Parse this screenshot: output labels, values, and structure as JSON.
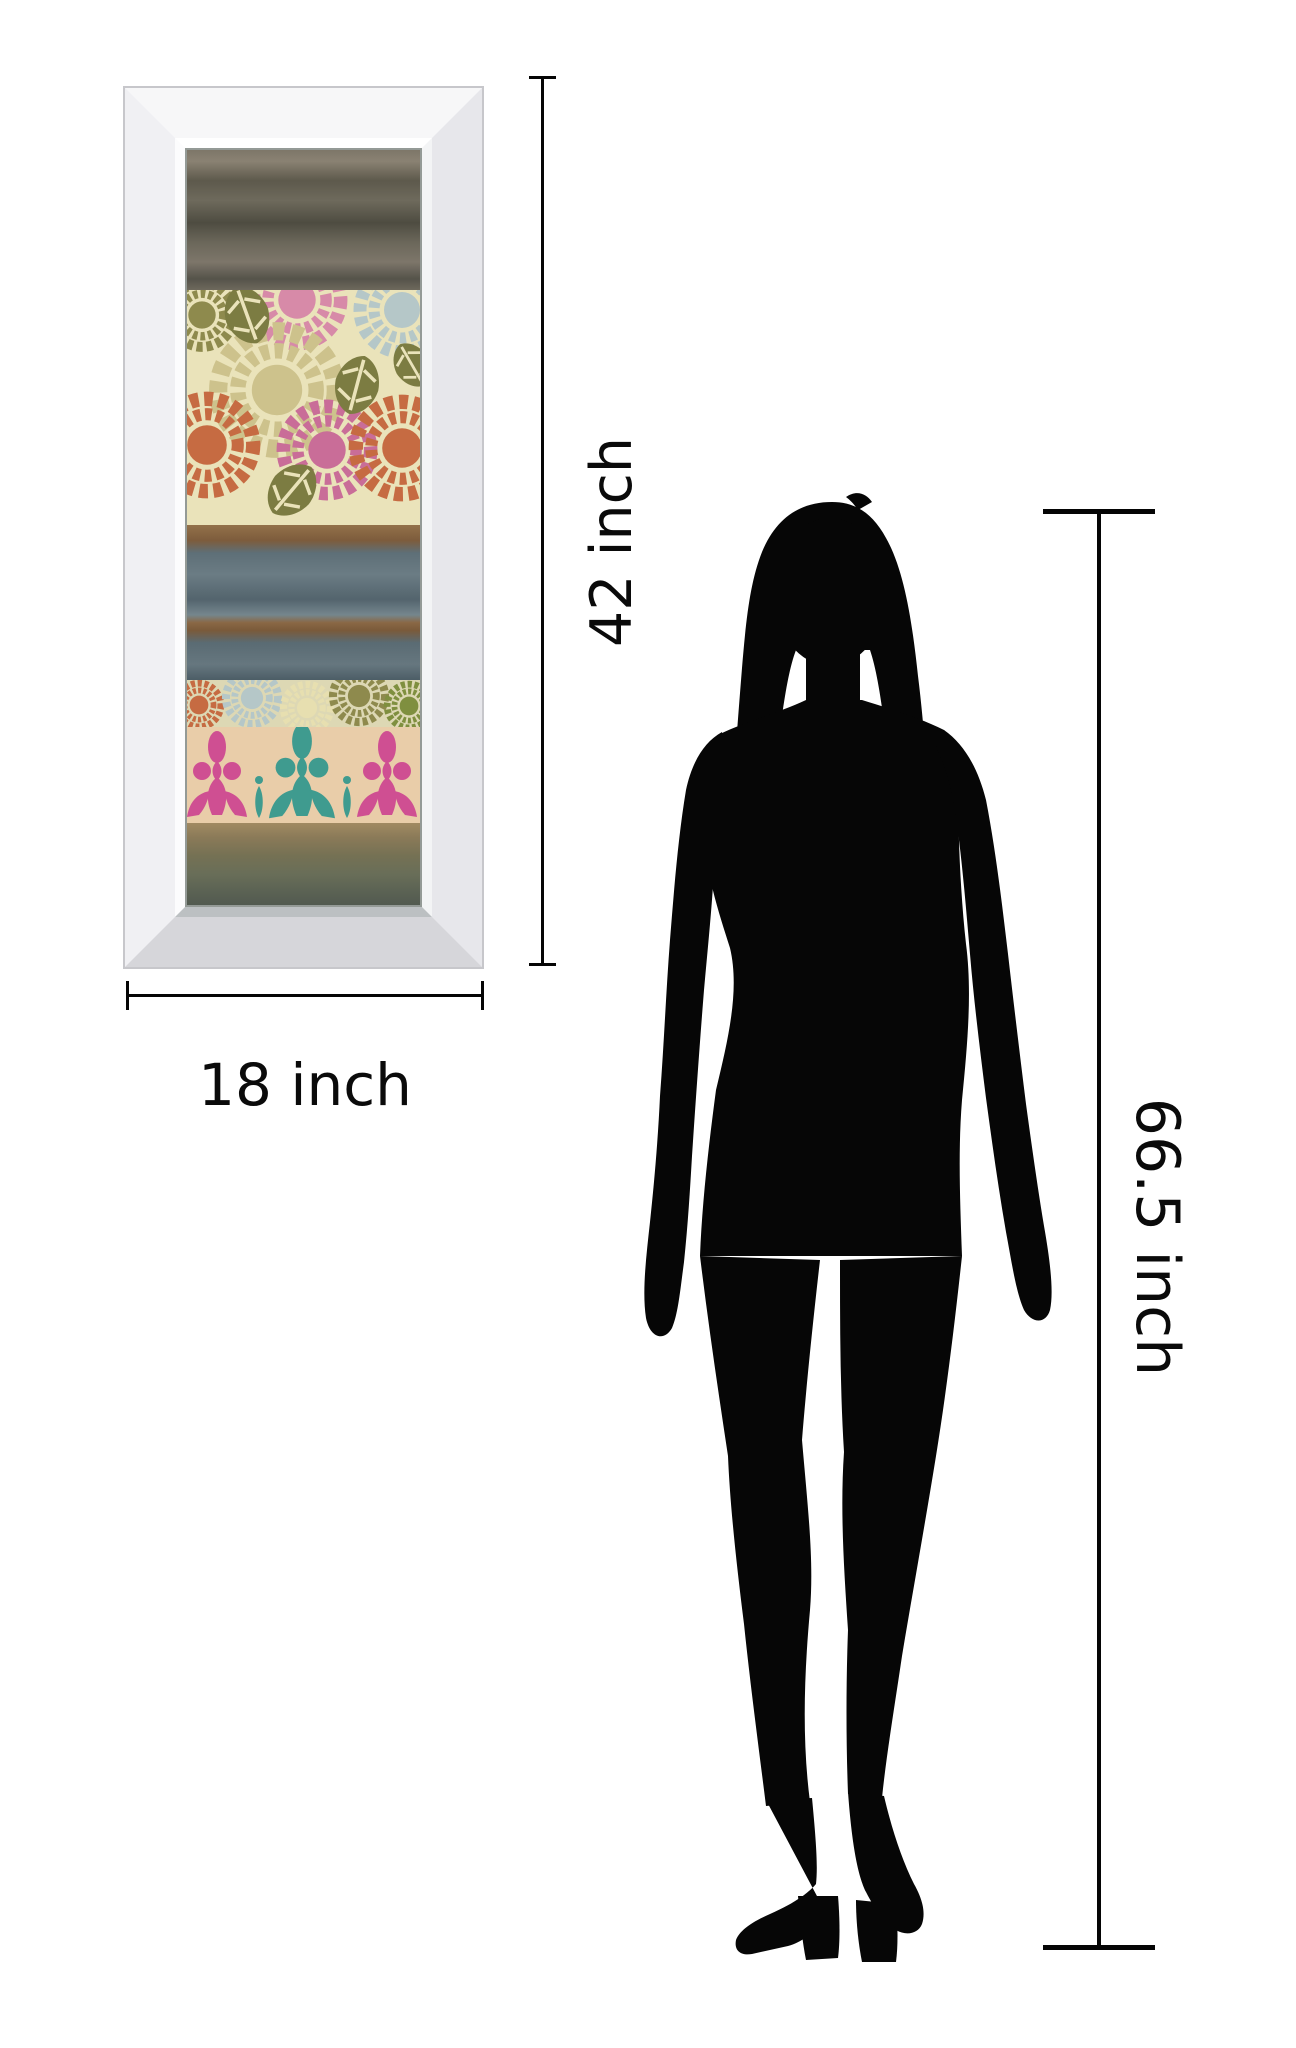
{
  "diagram": {
    "type": "product-size-comparison",
    "labels": {
      "frame_height": "42 inch",
      "frame_width": "18 inch",
      "person_height": "66.5 inch"
    },
    "figure": "woman-silhouette",
    "colors": {
      "background": "#ffffff",
      "dimension_lines": "#050505",
      "silhouette": "#060606",
      "frame_face": "#f2f2f4",
      "frame_bevel_bottom": "#bcc0c2",
      "art_dark_band": "#5d594c",
      "art_cream": "#eae3ba",
      "art_blue_band": "#66777f",
      "art_brown_stripe": "#8a6844",
      "art_olive_band": "#696e58",
      "mum_orange": "#c66b42",
      "mum_pink": "#d78aa8",
      "mum_deep_pink": "#c96d98",
      "mum_olive": "#8e8a4d",
      "mum_pale_blue": "#b5c7c8",
      "mum_cream": "#e7dfb0",
      "leaf_green": "#7c7c42",
      "damask_background": "#e9cda9",
      "damask_pink": "#cf4f92",
      "damask_teal": "#3f9b8f"
    }
  }
}
